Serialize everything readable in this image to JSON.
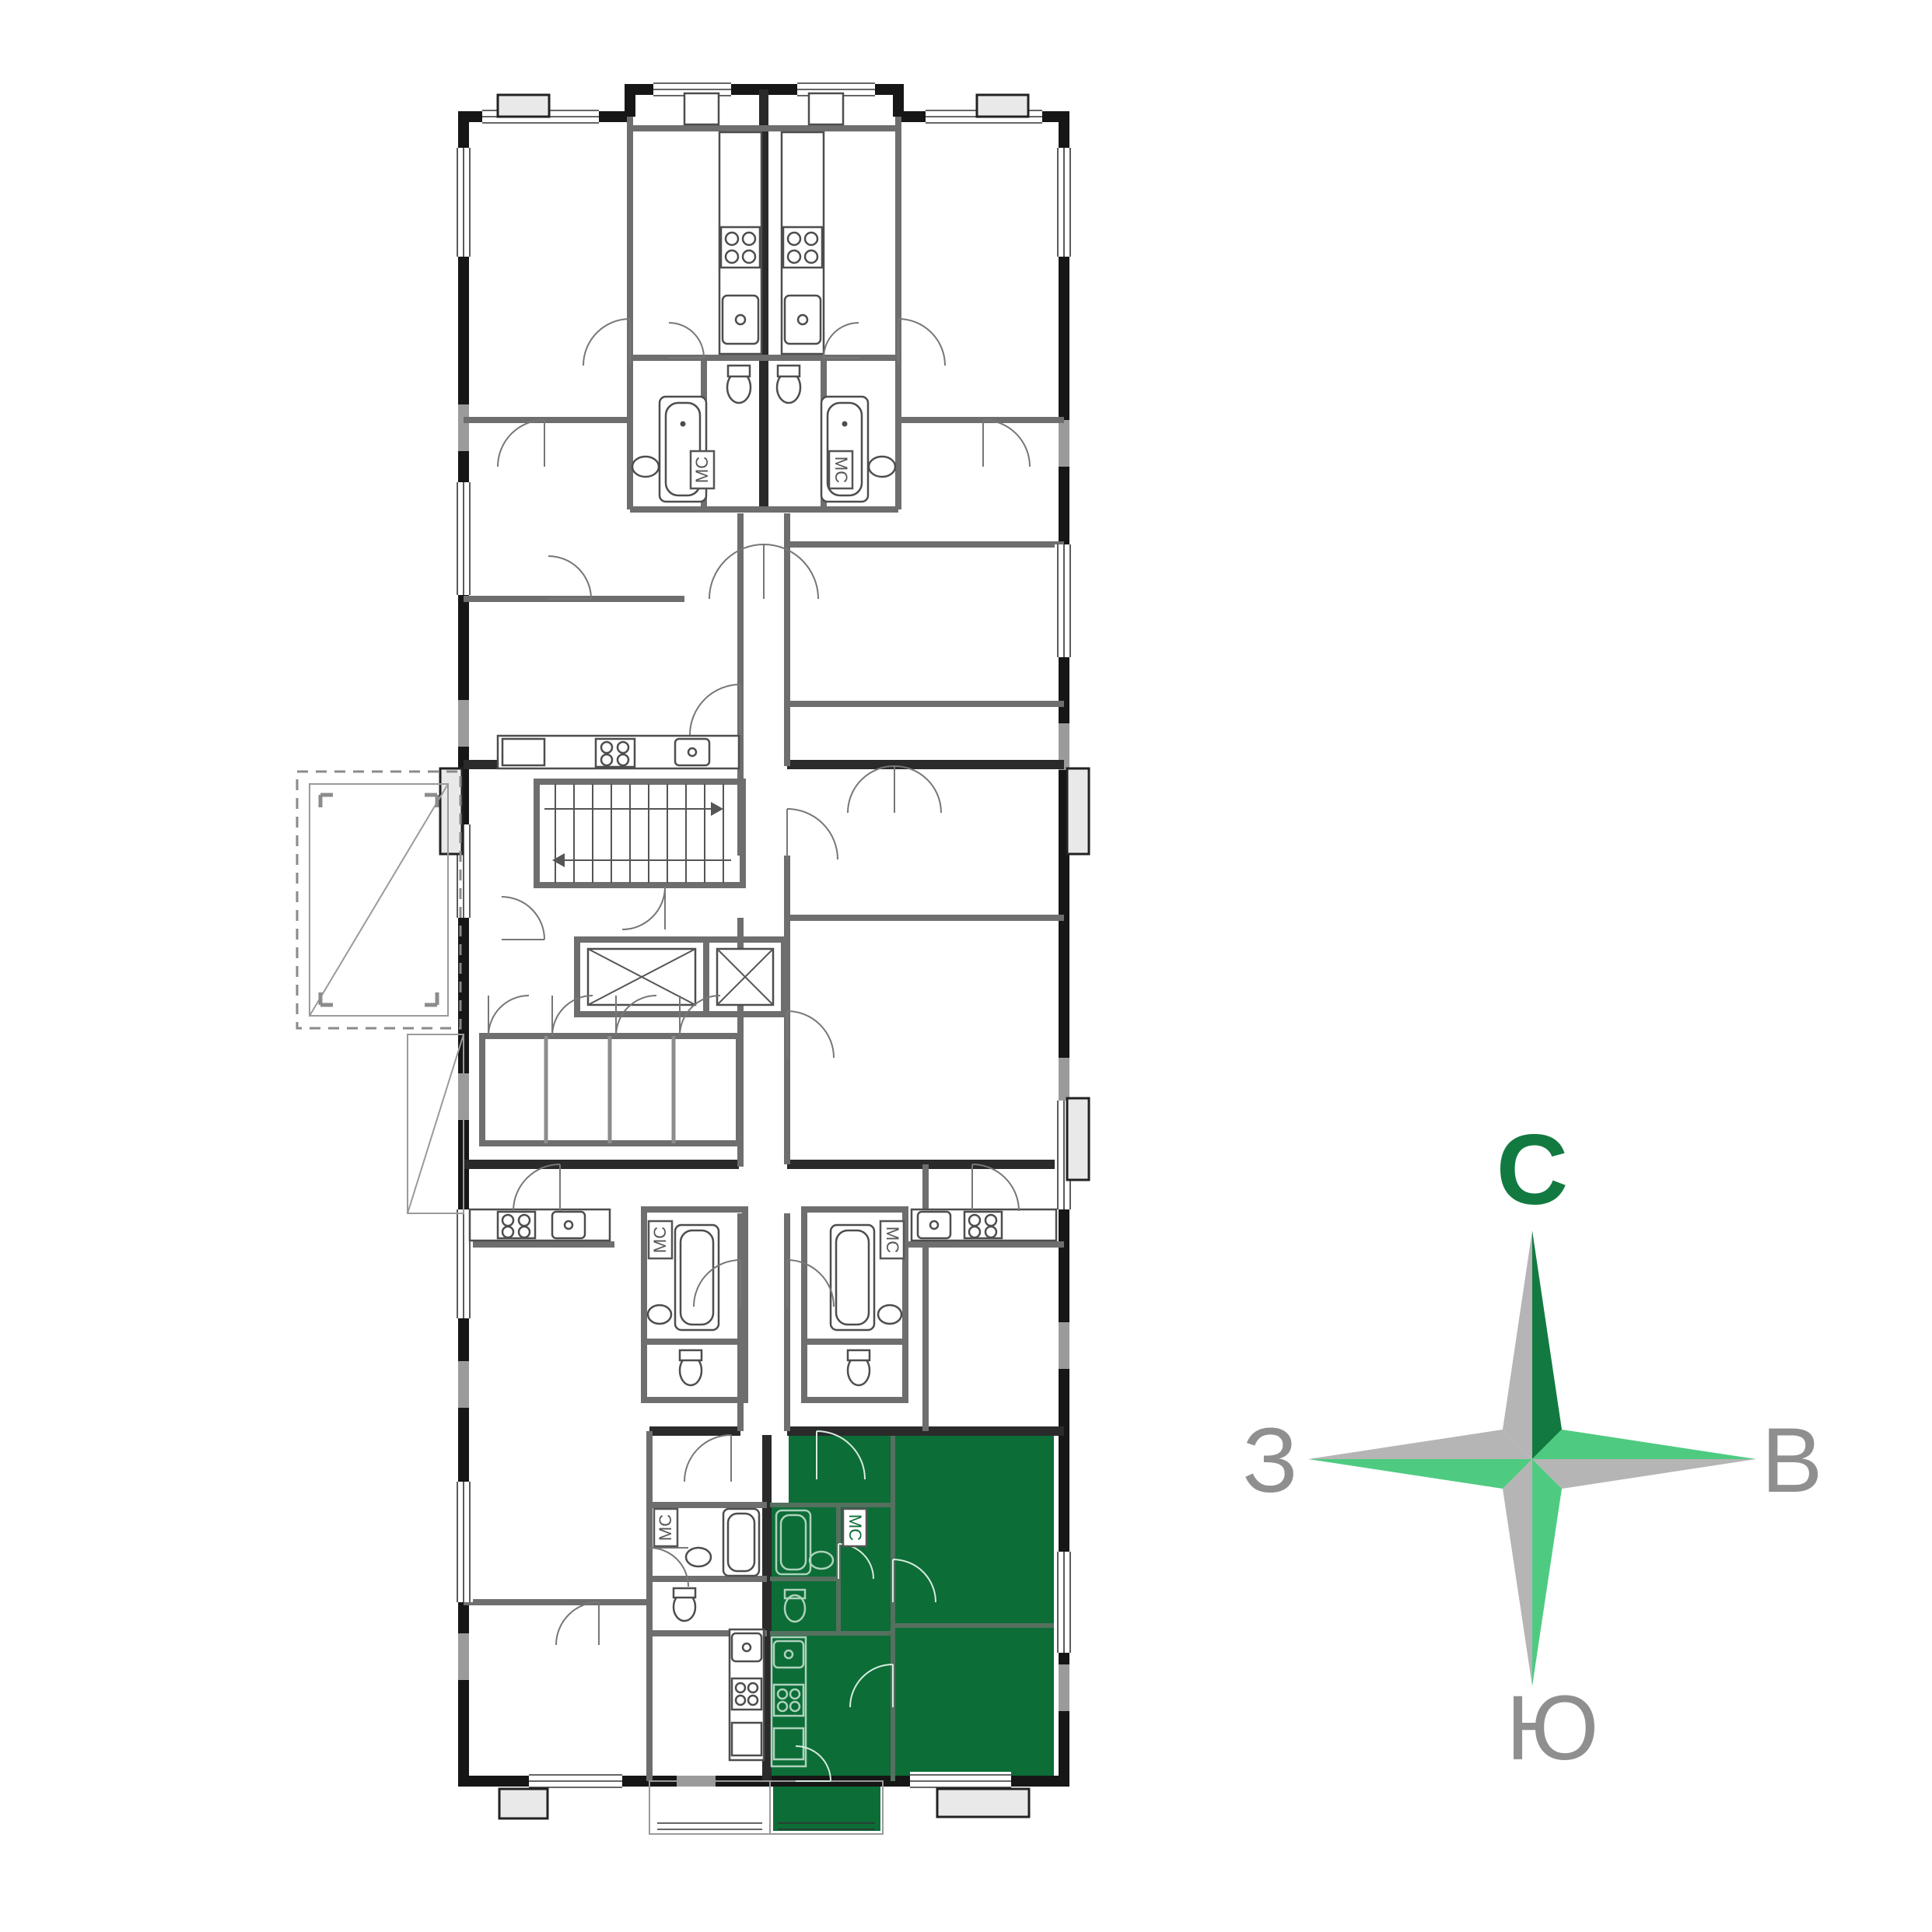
{
  "colors": {
    "highlight": "#0c6d37",
    "wall_dark": "#161616",
    "wall_mid": "#6e6e6e",
    "wall_light": "#9b9b9b",
    "slab_fill": "#e9e9e9",
    "fixture_stroke": "#4d4d4d",
    "fixture_on_green": "#aed2bc",
    "compass_dark_green": "#127a40",
    "compass_light_green": "#4ecb81",
    "compass_gray": "#b5b5b5",
    "compass_letter_gray": "#8f8f8f"
  },
  "plan": {
    "bathroom_label": "МС"
  },
  "compass": {
    "north": "С",
    "east": "В",
    "south": "Ю",
    "west": "З"
  }
}
